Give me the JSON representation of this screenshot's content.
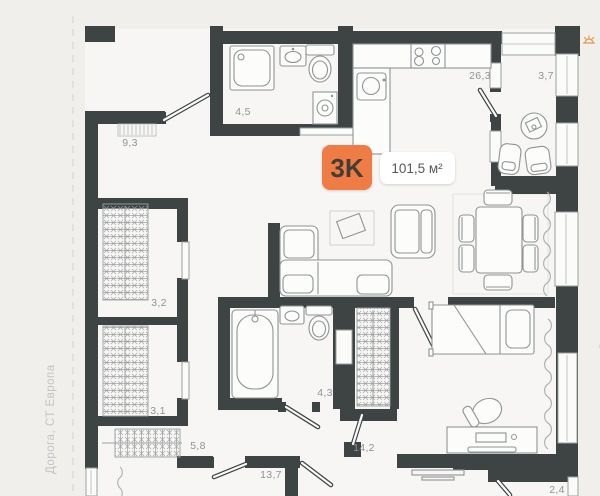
{
  "badge": {
    "rooms_label": "3K",
    "area_label": "101,5 м²"
  },
  "rooms": [
    {
      "name": "hallway",
      "area": "9,3"
    },
    {
      "name": "bathroom-small",
      "area": "4,5"
    },
    {
      "name": "kitchen-living",
      "area": "26,3"
    },
    {
      "name": "balcony-top",
      "area": "3,7"
    },
    {
      "name": "wardrobe-1",
      "area": "3,2"
    },
    {
      "name": "wardrobe-2",
      "area": "3,1"
    },
    {
      "name": "hallway-2",
      "area": "5,8"
    },
    {
      "name": "bedroom-1",
      "area": "13,7"
    },
    {
      "name": "bathroom-main",
      "area": "4,3"
    },
    {
      "name": "bedroom-2",
      "area": "14,2"
    },
    {
      "name": "balcony-bottom",
      "area": "2,4"
    }
  ],
  "surroundings": {
    "left": "Дорога, СТ Европа",
    "right": "Двор"
  },
  "icons": {
    "compass": "sun-path-compass-icon"
  },
  "colors": {
    "wall": "#3e4344",
    "accent": "#ef7c45",
    "furniture_stroke": "#8f9495",
    "label": "#8e9394"
  }
}
